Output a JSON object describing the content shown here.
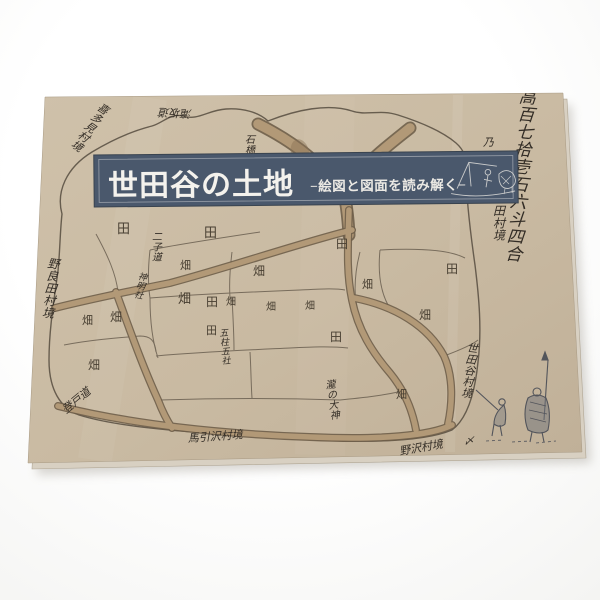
{
  "photo": {
    "background_color": "#fbfbfa",
    "subject": "booklet cover photographed on white surface"
  },
  "book": {
    "cover_color": "#c9baa2",
    "page_edge_color": "#d8d0c2",
    "banner": {
      "bg_color": "#4a586c",
      "border_color": "#b7bcc2",
      "title": "世田谷の土地",
      "subtitle": "−絵図と図面を読み解く−",
      "title_color": "#f4f2ed",
      "illustration": "horse-plowing-sketch"
    },
    "map": {
      "ink_color": "#473e31",
      "road_color": "#b29977",
      "boundary_color": "#5c5245",
      "field_labels": [
        {
          "t": "田",
          "x": 117,
          "y": 233,
          "s": 13
        },
        {
          "t": "田",
          "x": 204,
          "y": 237,
          "s": 13
        },
        {
          "t": "田",
          "x": 336,
          "y": 248,
          "s": 12
        },
        {
          "t": "田",
          "x": 446,
          "y": 273,
          "s": 12
        },
        {
          "t": "田",
          "x": 206,
          "y": 306,
          "s": 12
        },
        {
          "t": "田",
          "x": 206,
          "y": 334,
          "s": 11
        },
        {
          "t": "田",
          "x": 330,
          "y": 341,
          "s": 12
        },
        {
          "t": "畑",
          "x": 110,
          "y": 321,
          "s": 12
        },
        {
          "t": "畑",
          "x": 82,
          "y": 324,
          "s": 11
        },
        {
          "t": "畑",
          "x": 88,
          "y": 369,
          "s": 12
        },
        {
          "t": "畑",
          "x": 180,
          "y": 269,
          "s": 11
        },
        {
          "t": "畑",
          "x": 178,
          "y": 303,
          "s": 13
        },
        {
          "t": "畑",
          "x": 226,
          "y": 305,
          "s": 10
        },
        {
          "t": "畑",
          "x": 253,
          "y": 275,
          "s": 12
        },
        {
          "t": "畑",
          "x": 266,
          "y": 310,
          "s": 10
        },
        {
          "t": "畑",
          "x": 305,
          "y": 309,
          "s": 10
        },
        {
          "t": "畑",
          "x": 362,
          "y": 288,
          "s": 11
        },
        {
          "t": "畑",
          "x": 419,
          "y": 319,
          "s": 12
        },
        {
          "t": "畑",
          "x": 396,
          "y": 398,
          "s": 11
        }
      ],
      "annotations": [
        {
          "t": "喜多見村境",
          "x": 101,
          "y": 112,
          "s": 11,
          "rot": 35,
          "vertical": true
        },
        {
          "t": "滝坂道",
          "x": 192,
          "y": 110,
          "s": 11,
          "rot": 183
        },
        {
          "t": "石橋",
          "x": 250,
          "y": 143,
          "s": 10,
          "vertical": true
        },
        {
          "t": "乃",
          "x": 483,
          "y": 146,
          "s": 11
        },
        {
          "t": "高百七拾壱石六斗四合",
          "x": 527,
          "y": 103,
          "s": 17,
          "rot": 5,
          "vertical": true
        },
        {
          "t": "田村境",
          "x": 499,
          "y": 215,
          "s": 12,
          "vertical": true
        },
        {
          "t": "二子道",
          "x": 157,
          "y": 240,
          "s": 10,
          "vertical": true
        },
        {
          "t": "野良田村境",
          "x": 53,
          "y": 268,
          "s": 12,
          "rot": 6,
          "vertical": true
        },
        {
          "t": "神明社",
          "x": 142,
          "y": 280,
          "s": 9,
          "rot": 12,
          "vertical": true
        },
        {
          "t": "五柱五社",
          "x": 224,
          "y": 336,
          "s": 9,
          "rot": -5,
          "vertical": true
        },
        {
          "t": "瀧の大神",
          "x": 331,
          "y": 388,
          "s": 10,
          "rot": -8,
          "vertical": true
        },
        {
          "t": "世田谷村境",
          "x": 472,
          "y": 352,
          "s": 11,
          "rot": 7,
          "vertical": true
        },
        {
          "t": "登戸道",
          "x": 66,
          "y": 414,
          "s": 11,
          "rot": -40
        },
        {
          "t": "馬引沢村境",
          "x": 188,
          "y": 442,
          "s": 11,
          "rot": -4
        },
        {
          "t": "野沢村境",
          "x": 400,
          "y": 455,
          "s": 11,
          "rot": -10
        },
        {
          "t": "〆",
          "x": 464,
          "y": 444,
          "s": 10
        }
      ],
      "corner_illustration": "two-travelers-with-pole-sketch"
    }
  }
}
